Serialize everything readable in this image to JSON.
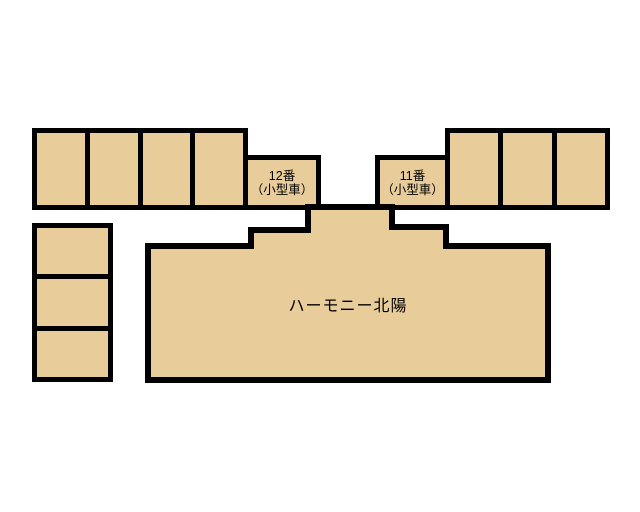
{
  "map": {
    "building": {
      "name": "ハーモニー北陽"
    },
    "spot_12": {
      "number": "12番",
      "car_type": "（小型車）"
    },
    "spot_11": {
      "number": "11番",
      "car_type": "（小型車）"
    },
    "parking": {
      "top_left_row_stalls": 4,
      "top_right_row_stalls": 3,
      "left_column_stalls": 3
    }
  },
  "colors": {
    "footprint_fill": "#e8cd9a",
    "outline": "#000000",
    "background": "#ffffff",
    "text": "#000000"
  }
}
